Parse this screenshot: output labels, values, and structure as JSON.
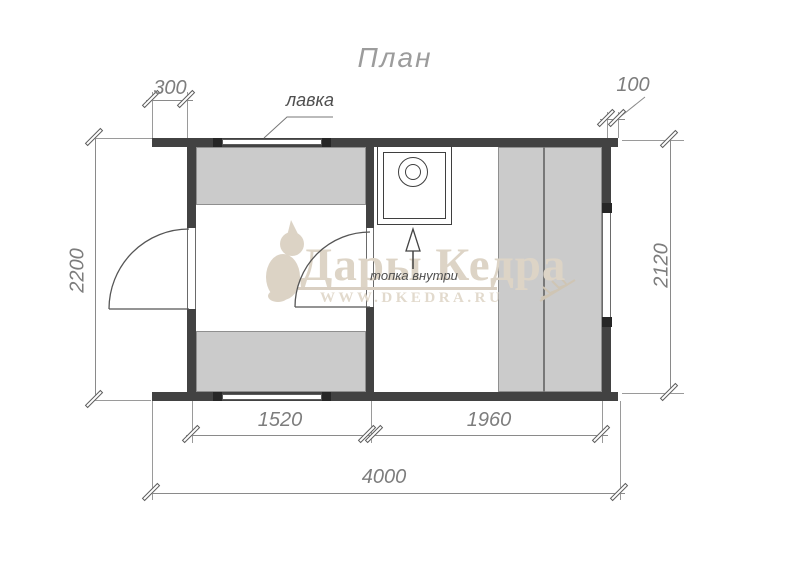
{
  "title": "План",
  "labels": {
    "bench": "лавка",
    "stove_note": "топка внутри"
  },
  "dimensions": {
    "left_overhang": "300",
    "right_overhang": "100",
    "height_left": "2200",
    "height_right": "2120",
    "room1_width": "1520",
    "room2_width": "1960",
    "total_width": "4000"
  },
  "watermark": {
    "brand": "Дары Кедра",
    "site": "WWW.DKEDRA.RU"
  },
  "icons": {
    "logo": "squirrel-icon",
    "stove": "stove-heater-icon",
    "arrow": "arrow-up-icon"
  },
  "colors": {
    "wall": "#424242",
    "bench_fill": "#cbcbcb",
    "bench_border": "#8f8f8f",
    "dimension": "#7d7d7d",
    "watermark": "#ddd4c6",
    "background": "#ffffff"
  }
}
